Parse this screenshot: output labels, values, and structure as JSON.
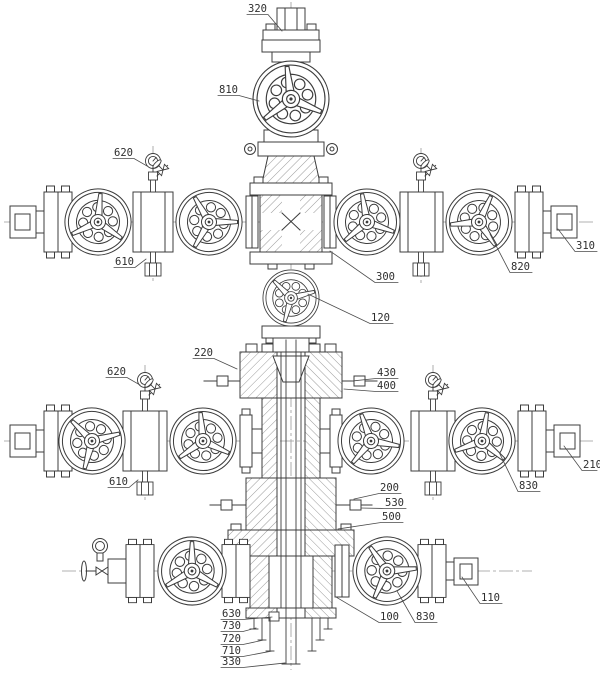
{
  "canvas": {
    "width": 600,
    "height": 674
  },
  "colors": {
    "background": "#ffffff",
    "ink": "#3c3c3c",
    "hatch": "#6e6e6e",
    "centerline": "#999999",
    "label_ink": "#2e2e2e"
  },
  "labels": [
    {
      "t": "320",
      "x": 248,
      "y": 12,
      "pts": [
        [
          247,
          14.5
        ],
        [
          268,
          14.5
        ],
        [
          282,
          31
        ]
      ]
    },
    {
      "t": "810",
      "x": 219,
      "y": 93,
      "pts": [
        [
          218,
          95.5
        ],
        [
          239,
          95.5
        ],
        [
          259,
          101
        ]
      ]
    },
    {
      "t": "620",
      "x": 114,
      "y": 156,
      "pts": [
        [
          113,
          158.5
        ],
        [
          134,
          158.5
        ],
        [
          147,
          166
        ]
      ]
    },
    {
      "t": "610",
      "x": 115,
      "y": 265,
      "pts": [
        [
          114,
          267.5
        ],
        [
          135,
          267.5
        ],
        [
          146,
          259
        ]
      ]
    },
    {
      "t": "300",
      "x": 376,
      "y": 280,
      "pts": [
        [
          398,
          282.5
        ],
        [
          375,
          282.5
        ],
        [
          330,
          251
        ]
      ]
    },
    {
      "t": "120",
      "x": 371,
      "y": 321,
      "pts": [
        [
          393,
          323.5
        ],
        [
          370,
          323.5
        ],
        [
          308,
          294
        ]
      ]
    },
    {
      "t": "310",
      "x": 576,
      "y": 249,
      "pts": [
        [
          597,
          251.5
        ],
        [
          575,
          251.5
        ],
        [
          558,
          229
        ]
      ]
    },
    {
      "t": "820",
      "x": 511,
      "y": 270,
      "pts": [
        [
          532,
          272.5
        ],
        [
          510,
          272.5
        ],
        [
          490,
          234
        ]
      ]
    },
    {
      "t": "220",
      "x": 194,
      "y": 356,
      "pts": [
        [
          193,
          358.5
        ],
        [
          214,
          358.5
        ],
        [
          237,
          369
        ]
      ]
    },
    {
      "t": "430",
      "x": 377,
      "y": 376,
      "pts": [
        [
          398,
          378.5
        ],
        [
          376,
          378.5
        ],
        [
          352,
          381
        ]
      ]
    },
    {
      "t": "400",
      "x": 377,
      "y": 389,
      "pts": [
        [
          398,
          391.5
        ],
        [
          376,
          391.5
        ],
        [
          344,
          389
        ]
      ]
    },
    {
      "t": "620",
      "x": 107,
      "y": 375,
      "pts": [
        [
          106,
          377.5
        ],
        [
          127,
          377.5
        ],
        [
          140,
          385
        ]
      ]
    },
    {
      "t": "610",
      "x": 109,
      "y": 485,
      "pts": [
        [
          108,
          487.5
        ],
        [
          129,
          487.5
        ],
        [
          138,
          480
        ]
      ]
    },
    {
      "t": "210",
      "x": 583,
      "y": 468,
      "pts": [
        [
          597,
          470.5
        ],
        [
          582,
          470.5
        ],
        [
          564,
          446
        ]
      ]
    },
    {
      "t": "830",
      "x": 519,
      "y": 489,
      "pts": [
        [
          540,
          491.5
        ],
        [
          518,
          491.5
        ],
        [
          499,
          452
        ]
      ]
    },
    {
      "t": "200",
      "x": 380,
      "y": 491,
      "pts": [
        [
          401,
          493.5
        ],
        [
          379,
          493.5
        ],
        [
          354,
          499
        ]
      ]
    },
    {
      "t": "530",
      "x": 385,
      "y": 506,
      "pts": [
        [
          406,
          508.5
        ],
        [
          384,
          508.5
        ],
        [
          361,
          508
        ]
      ]
    },
    {
      "t": "500",
      "x": 382,
      "y": 520,
      "pts": [
        [
          403,
          522.5
        ],
        [
          381,
          522.5
        ],
        [
          338,
          529
        ]
      ]
    },
    {
      "t": "110",
      "x": 481,
      "y": 601,
      "pts": [
        [
          502,
          603.5
        ],
        [
          480,
          603.5
        ],
        [
          462,
          577
        ]
      ]
    },
    {
      "t": "100",
      "x": 380,
      "y": 620,
      "pts": [
        [
          401,
          622.5
        ],
        [
          379,
          622.5
        ],
        [
          336,
          597
        ]
      ]
    },
    {
      "t": "830",
      "x": 416,
      "y": 620,
      "pts": [
        [
          437,
          622.5
        ],
        [
          415,
          622.5
        ],
        [
          397,
          591
        ]
      ]
    },
    {
      "t": "630",
      "x": 222,
      "y": 617,
      "pts": [
        [
          221,
          619.5
        ],
        [
          243,
          619.5
        ],
        [
          272,
          617
        ]
      ]
    },
    {
      "t": "730",
      "x": 222,
      "y": 629,
      "pts": [
        [
          221,
          631.5
        ],
        [
          243,
          631.5
        ],
        [
          256,
          628
        ]
      ]
    },
    {
      "t": "720",
      "x": 222,
      "y": 642,
      "pts": [
        [
          221,
          644.5
        ],
        [
          243,
          644.5
        ],
        [
          264,
          640
        ]
      ]
    },
    {
      "t": "710",
      "x": 222,
      "y": 654,
      "pts": [
        [
          221,
          656.5
        ],
        [
          243,
          656.5
        ],
        [
          272,
          651
        ]
      ]
    },
    {
      "t": "330",
      "x": 222,
      "y": 665,
      "pts": [
        [
          221,
          667.5
        ],
        [
          243,
          667.5
        ],
        [
          285,
          663
        ]
      ]
    }
  ]
}
